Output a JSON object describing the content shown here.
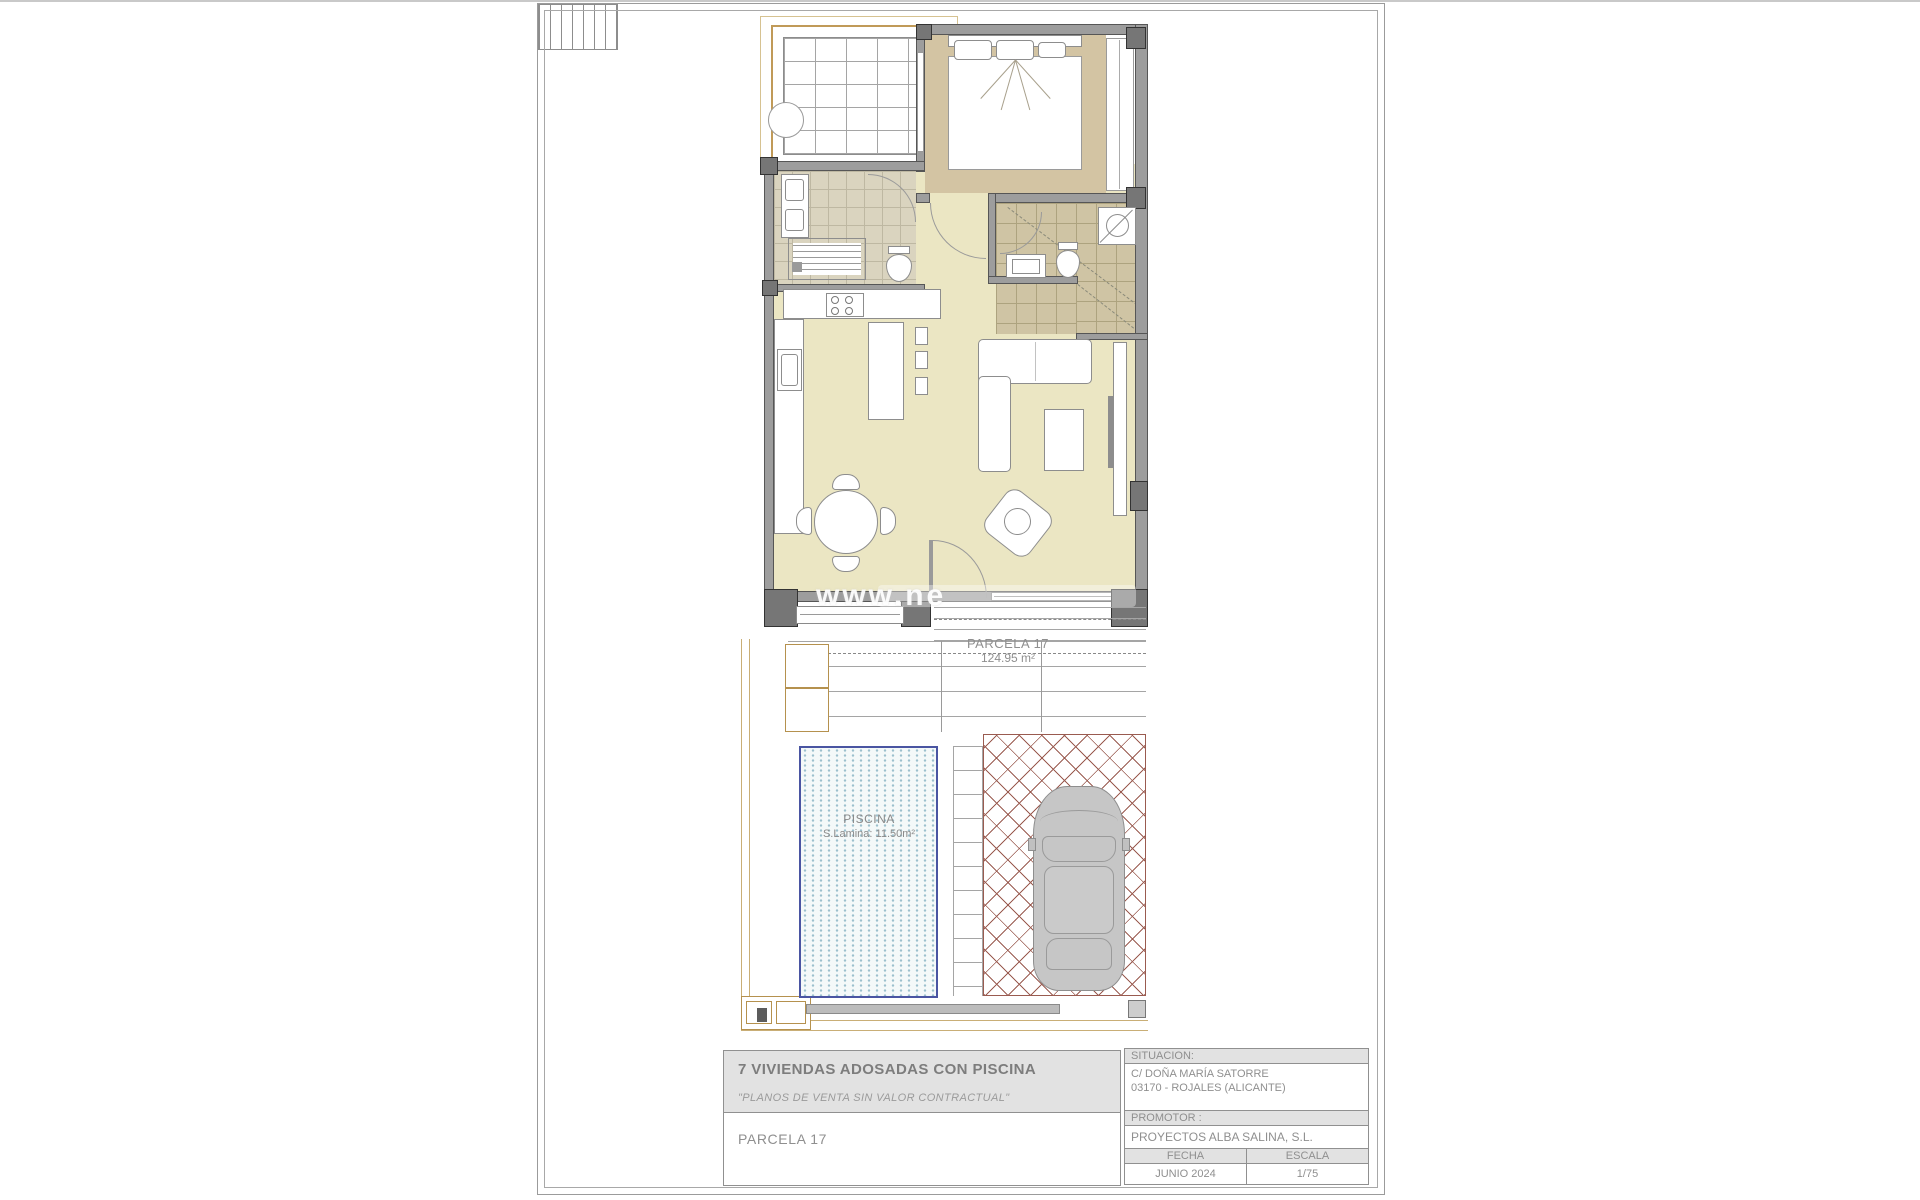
{
  "plan": {
    "watermark": "www.ne",
    "parcel_label": {
      "name": "PARCELA 17",
      "area": "124.95 m²"
    },
    "pool_label": {
      "name": "PISCINA",
      "area": "S.Lamina: 11.50m²"
    }
  },
  "title_block": {
    "project_title": "7 VIVIENDAS ADOSADAS CON PISCINA",
    "disclaimer": "\"PLANOS DE VENTA SIN VALOR CONTRACTUAL\"",
    "sheet_name": "PARCELA 17",
    "situacion": {
      "label": "SITUACION:",
      "address_line1": "C/ DOÑA MARÍA SATORRE",
      "address_line2": "03170 - ROJALES (ALICANTE)"
    },
    "promotor": {
      "label": "PROMOTOR :",
      "value": "PROYECTOS ALBA SALINA, S.L."
    },
    "fecha": {
      "label": "FECHA",
      "value": "JUNIO 2024"
    },
    "escala": {
      "label": "ESCALA",
      "value": "1/75"
    }
  },
  "colors": {
    "wall": "#9d9d9d",
    "wall_post": "#767676",
    "floor_living": "#ebe6c3",
    "floor_bedroom": "#d3c4a3",
    "floor_bath_left": "#dad4bf",
    "floor_bath_right": "#cfc4a4",
    "pool_border": "#4a55a2",
    "pool_dots": "#9cc0cd",
    "paving_line": "#9a5b50",
    "plot_line": "#c9ae76",
    "text_gray": "#8f8f8f"
  }
}
